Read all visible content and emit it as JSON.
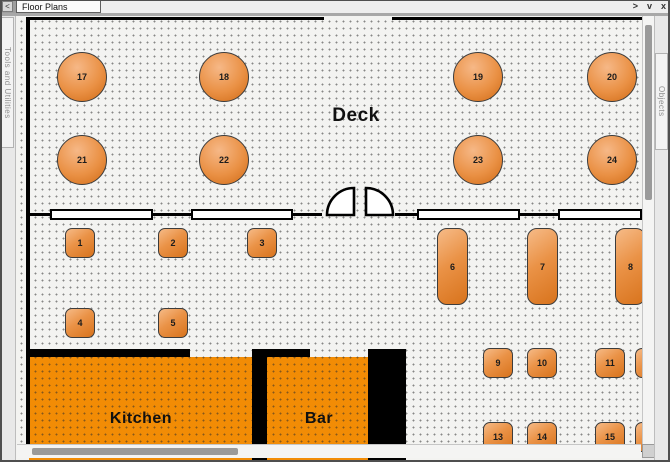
{
  "window": {
    "back_button": "<",
    "tab_label": "Floor Plans",
    "left_panel_label": "Tools and Utilities",
    "right_panel_label": "Objects",
    "controls": {
      "expand": ">",
      "collapse": "v",
      "close": "x"
    }
  },
  "plan": {
    "room_labels": {
      "deck": "Deck",
      "kitchen": "Kitchen",
      "bar": "Bar"
    },
    "tables": {
      "round": [
        "17",
        "18",
        "19",
        "20",
        "21",
        "22",
        "23",
        "24"
      ],
      "square": [
        "1",
        "2",
        "3",
        "4",
        "5"
      ],
      "rect": [
        "6",
        "7",
        "8"
      ],
      "small_top": [
        "9",
        "10",
        "11"
      ],
      "small_bottom": [
        "13",
        "14",
        "15"
      ]
    },
    "colors": {
      "table_light": "#f6b887",
      "table_dark": "#d06a15",
      "room_fill": "#f28c05",
      "wall": "#000000",
      "canvas_bg": "#f3f3f1"
    }
  }
}
